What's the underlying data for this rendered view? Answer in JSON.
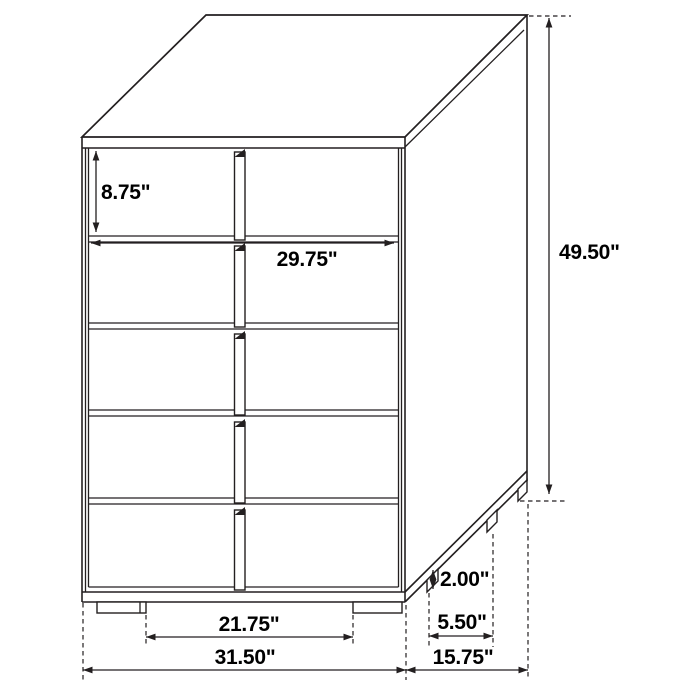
{
  "diagram": {
    "subject": "five-drawer-chest-dimension-drawing",
    "units": "inches"
  },
  "dimensions": {
    "top_drawer_height": "8.75\"",
    "drawer_front_width": "29.75\"",
    "overall_height": "49.50\"",
    "leg_height": "2.00\"",
    "side_leg_spacing": "5.50\"",
    "front_leg_spacing": "21.75\"",
    "overall_width": "31.50\"",
    "overall_depth": "15.75\""
  },
  "colors": {
    "line": "#231f20",
    "text": "#000000",
    "background": "#ffffff"
  }
}
